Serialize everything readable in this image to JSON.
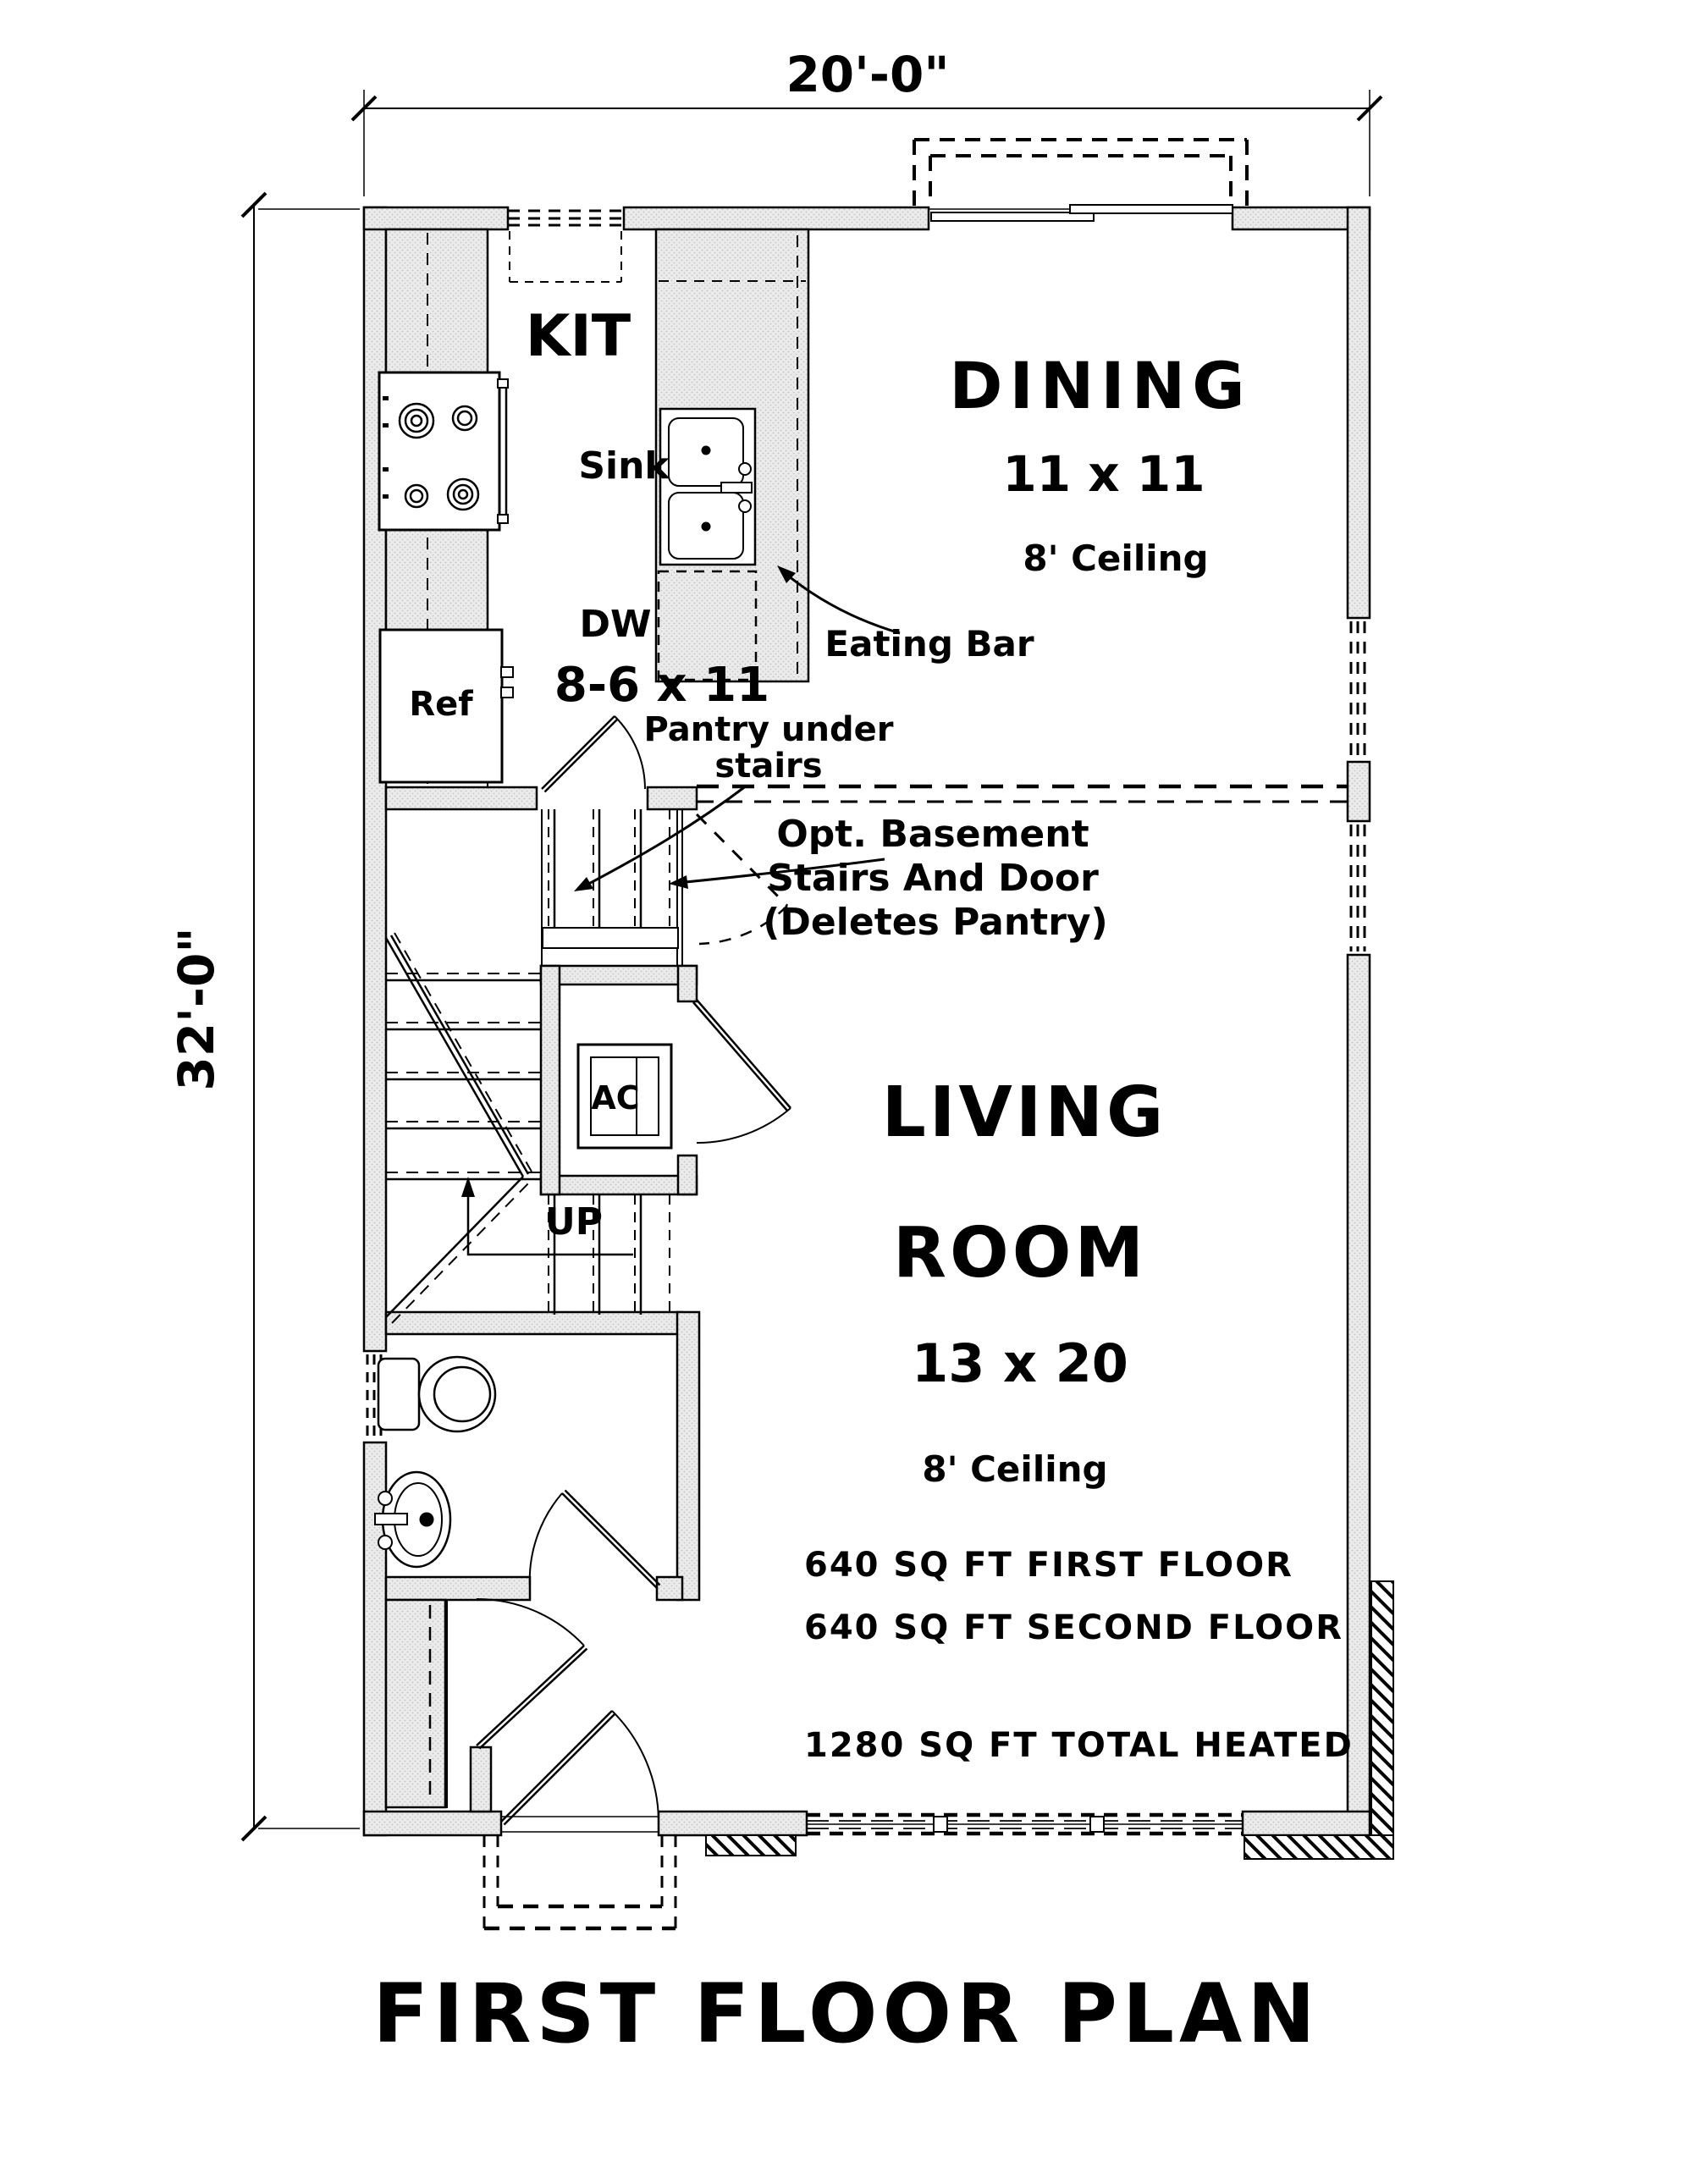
{
  "page": {
    "background": "#ffffff",
    "title": "FIRST FLOOR PLAN"
  },
  "dimensions": {
    "width": "20'-0\"",
    "depth": "32'-0\""
  },
  "rooms": {
    "kitchen": {
      "label": "KIT",
      "size": "8-6 x 11"
    },
    "dining": {
      "label": "DINING",
      "size": "11 x 11",
      "ceiling": "8' Ceiling"
    },
    "living": {
      "label_line1": "LIVING",
      "label_line2": "ROOM",
      "size": "13 x 20",
      "ceiling": "8' Ceiling"
    }
  },
  "fixtures": {
    "sink": "Sink",
    "dishwasher": "DW",
    "refrigerator": "Ref",
    "eating_bar": "Eating Bar",
    "ac": "AC",
    "up": "UP"
  },
  "notes": {
    "pantry_line1": "Pantry under",
    "pantry_line2": "stairs",
    "basement_line1": "Opt.  Basement",
    "basement_line2": "Stairs And Door",
    "basement_line3": "(Deletes Pantry)"
  },
  "area_summary": {
    "first_floor": "640 SQ FT FIRST FLOOR",
    "second_floor": "640 SQ FT SECOND FLOOR",
    "total": "1280 SQ FT TOTAL HEATED"
  },
  "colors": {
    "wall_fill": "#e9e9e9",
    "line": "#000000"
  }
}
